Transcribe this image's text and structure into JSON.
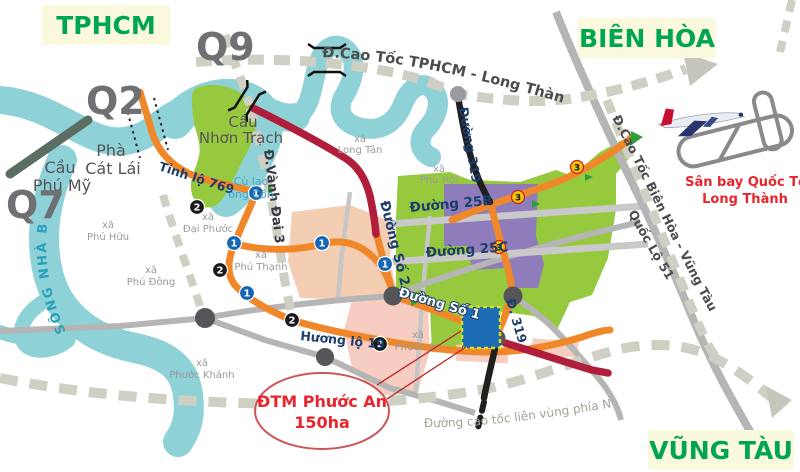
{
  "regions": {
    "tphcm": "TPHCM",
    "bien_hoa": "BIÊN HÒA",
    "vung_tau": "VŨNG TÀU"
  },
  "districts": {
    "q2": "Q2",
    "q7": "Q7",
    "q9": "Q9"
  },
  "landmarks": {
    "cau_phu_my_1": "Cầu",
    "cau_phu_my_2": "Phú Mỹ",
    "pha_cat_lai_1": "Phà",
    "pha_cat_lai_2": "Cát Lái",
    "cau_nhon_trach_1": "Cầu",
    "cau_nhon_trach_2": "Nhơn Trạch",
    "cu_lao_1": "Cù lao",
    "cu_lao_2": "ông Cồn",
    "song_nha_be": "SÔNG NHÀ BÈ",
    "airport_1": "Sân bay Quốc Tế",
    "airport_2": "Long Thành"
  },
  "roads": {
    "cao_toc_tphcm": "Đ.Cao Tốc TPHCM - Long Thành",
    "cao_toc_bien_hoa": "Đ.Cao Tốc Biên Hòa - Vũng Tàu",
    "quoc_lo_51": "Quốc Lộ 51",
    "cao_toc_lien_vung": "Đường cao tốc liên vùng phía Nam",
    "tinh_lo_769": "Tỉnh lộ 769",
    "vanh_dai_3": "Đ.Vành Đai 3",
    "duong_so_2": "Đường Số 2",
    "duong_so_1": "Đường Số 1",
    "duong_25b": "Đường 25B",
    "duong_25c": "Đường 25C",
    "duong_319": "Đường 319",
    "d_319": "Đ. 319",
    "huong_lo_19": "Hương lộ 19"
  },
  "communes": {
    "prefix": "xã",
    "phu_huu": "Phú Hữu",
    "dai_phuoc": "Đại Phước",
    "phu_thanh": "Phú Thạnh",
    "phu_dong": "Phú Đông",
    "phuoc_khanh": "Phước Khánh",
    "long_tan": "Long Tân",
    "phu_hoi": "Phú Hội",
    "phuoc_an": "Phước An"
  },
  "callout": {
    "line1": "ĐTM Phước An",
    "line2": "150ha"
  },
  "markers": {
    "blue": "1",
    "black": "2",
    "yellow": "3"
  },
  "colors": {
    "river": "#8ed1d7",
    "green_zone": "#97c93f",
    "purple_zone": "#8f7cba",
    "peach_zone": "#f4ceb2",
    "pink_zone": "#f6cdc0",
    "orange_road": "#f0882a",
    "crimson_road": "#b01e3c",
    "black_road": "#1f1f1f",
    "dashed_road": "#cfcfc3",
    "label_bg": "#fbf9dd",
    "region_green": "#00a551",
    "red_text": "#e8252c",
    "project_blue": "#1b6cb5"
  }
}
